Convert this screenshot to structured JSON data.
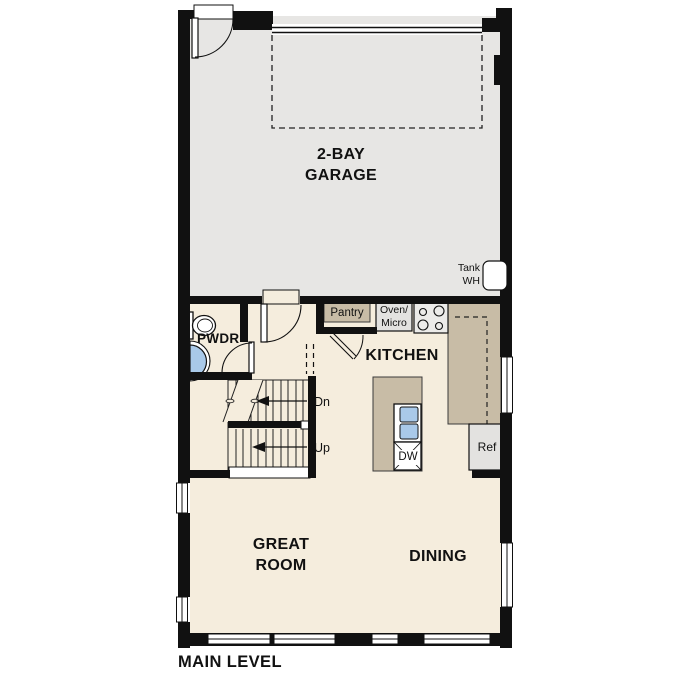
{
  "plan_title": "MAIN LEVEL",
  "rooms": {
    "garage": "2-BAY\nGARAGE",
    "kitchen": "KITCHEN",
    "great_room": "GREAT\nROOM",
    "dining": "DINING",
    "powder_room": "PWDR"
  },
  "features": {
    "pantry": "Pantry",
    "oven_micro": "Oven/\nMicro",
    "tank_water_heater": "Tank\nWH",
    "dishwasher": "DW",
    "refrigerator": "Ref",
    "stairs_down": "Dn",
    "stairs_up": "Up"
  },
  "colors": {
    "wall": "#111111",
    "garage_floor": "#e7e6e4",
    "living_floor": "#f5eddd",
    "counter": "#c8bca6",
    "appliance": "#e3e2e0",
    "sink_fixture": "#a9c9e9"
  }
}
